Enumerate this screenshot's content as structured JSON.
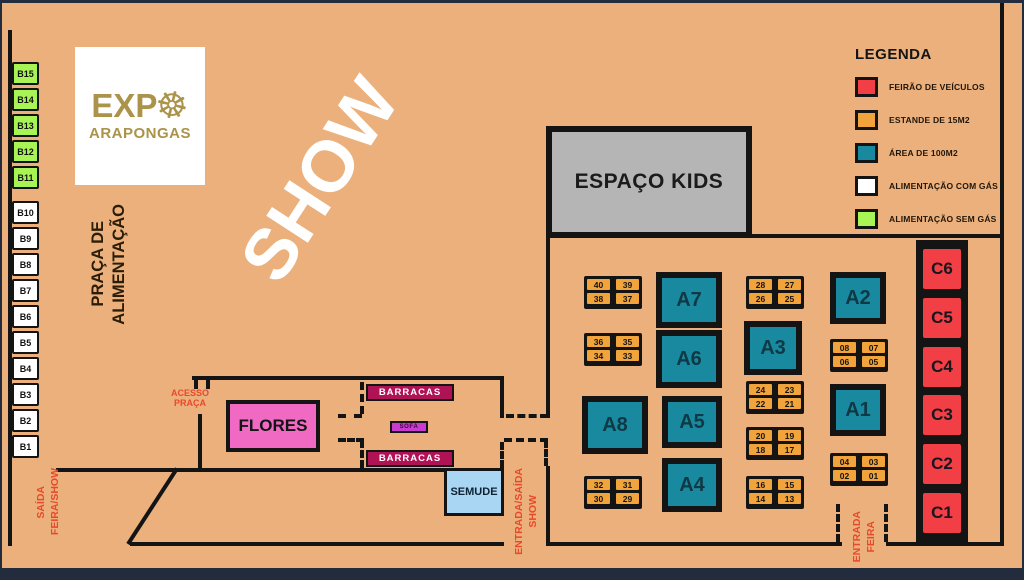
{
  "colors": {
    "background": "#ebb07c",
    "wall": "#141414",
    "frame": "#232c3c",
    "teal_area": "#1989a0",
    "red_vehicle_fair": "#f23e45",
    "orange_stand": "#f1a33c",
    "green_food_no_gas": "#a8f455",
    "white_food_gas": "#ffffff",
    "pink_flowers": "#f06ac4",
    "crimson_barracas": "#b01355",
    "magenta_small_stand": "#c93ad1",
    "lightblue_semude": "#a9d6f2",
    "gray_kids": "#b5b5b5",
    "gold_logo": "#ab9349",
    "gate_text": "#e8492b"
  },
  "logo": {
    "text_top": "EXP",
    "wheel_icon": "☸",
    "text_bottom": "ARAPONGAS"
  },
  "show_label": "SHOW",
  "praca": {
    "line1": "PRAÇA DE",
    "line2": "ALIMENTAÇÃO"
  },
  "espaco_kids_label": "ESPAÇO KIDS",
  "flores_label": "FLORES",
  "barracas_top_label": "BARRACAS",
  "barracas_bottom_label": "BARRACAS",
  "sofa_label": "SOFÁ",
  "semude_label": "SEMUDE",
  "access_labels": {
    "acesso_praca": {
      "line1": "ACESSO",
      "line2": "PRAÇA"
    },
    "saida_feira_show": {
      "line1": "SAÍDA",
      "line2": "FEIRA/SHOW"
    },
    "entrada_saida_show": {
      "line1": "ENTRADA/SAÍDA",
      "line2": "SHOW"
    },
    "entrada_feira": {
      "line1": "ENTRADA",
      "line2": "FEIRA"
    }
  },
  "b_boxes_green": [
    "B15",
    "B14",
    "B13",
    "B12",
    "B11"
  ],
  "b_boxes_white": [
    "B10",
    "B9",
    "B8",
    "B7",
    "B6",
    "B5",
    "B4",
    "B3",
    "B2",
    "B1"
  ],
  "a_boxes": [
    "A7",
    "A6",
    "A8",
    "A5",
    "A4",
    "A3",
    "A2",
    "A1"
  ],
  "c_boxes": [
    "C6",
    "C5",
    "C4",
    "C3",
    "C2",
    "C1"
  ],
  "stand_groups": [
    {
      "cells": [
        "40",
        "39",
        "38",
        "37"
      ]
    },
    {
      "cells": [
        "36",
        "35",
        "34",
        "33"
      ]
    },
    {
      "cells": [
        "32",
        "31",
        "30",
        "29"
      ]
    },
    {
      "cells": [
        "28",
        "27",
        "26",
        "25"
      ]
    },
    {
      "cells": [
        "24",
        "23",
        "22",
        "21"
      ]
    },
    {
      "cells": [
        "20",
        "19",
        "18",
        "17"
      ]
    },
    {
      "cells": [
        "16",
        "15",
        "14",
        "13"
      ]
    },
    {
      "cells": [
        "08",
        "07",
        "06",
        "05"
      ]
    },
    {
      "cells": [
        "04",
        "03",
        "02",
        "01"
      ]
    }
  ],
  "legend": {
    "title": "LEGENDA",
    "items": [
      {
        "label": "FEIRÃO DE VEÍCULOS",
        "color": "#f23e45"
      },
      {
        "label": "ESTANDE DE 15M2",
        "color": "#f1a33c"
      },
      {
        "label": "ÁREA DE 100M2",
        "color": "#1989a0"
      },
      {
        "label": "ALIMENTAÇÃO  COM GÁS",
        "color": "#ffffff"
      },
      {
        "label": "ALIMENTAÇÃO  SEM GÁS",
        "color": "#a8f455"
      }
    ]
  }
}
